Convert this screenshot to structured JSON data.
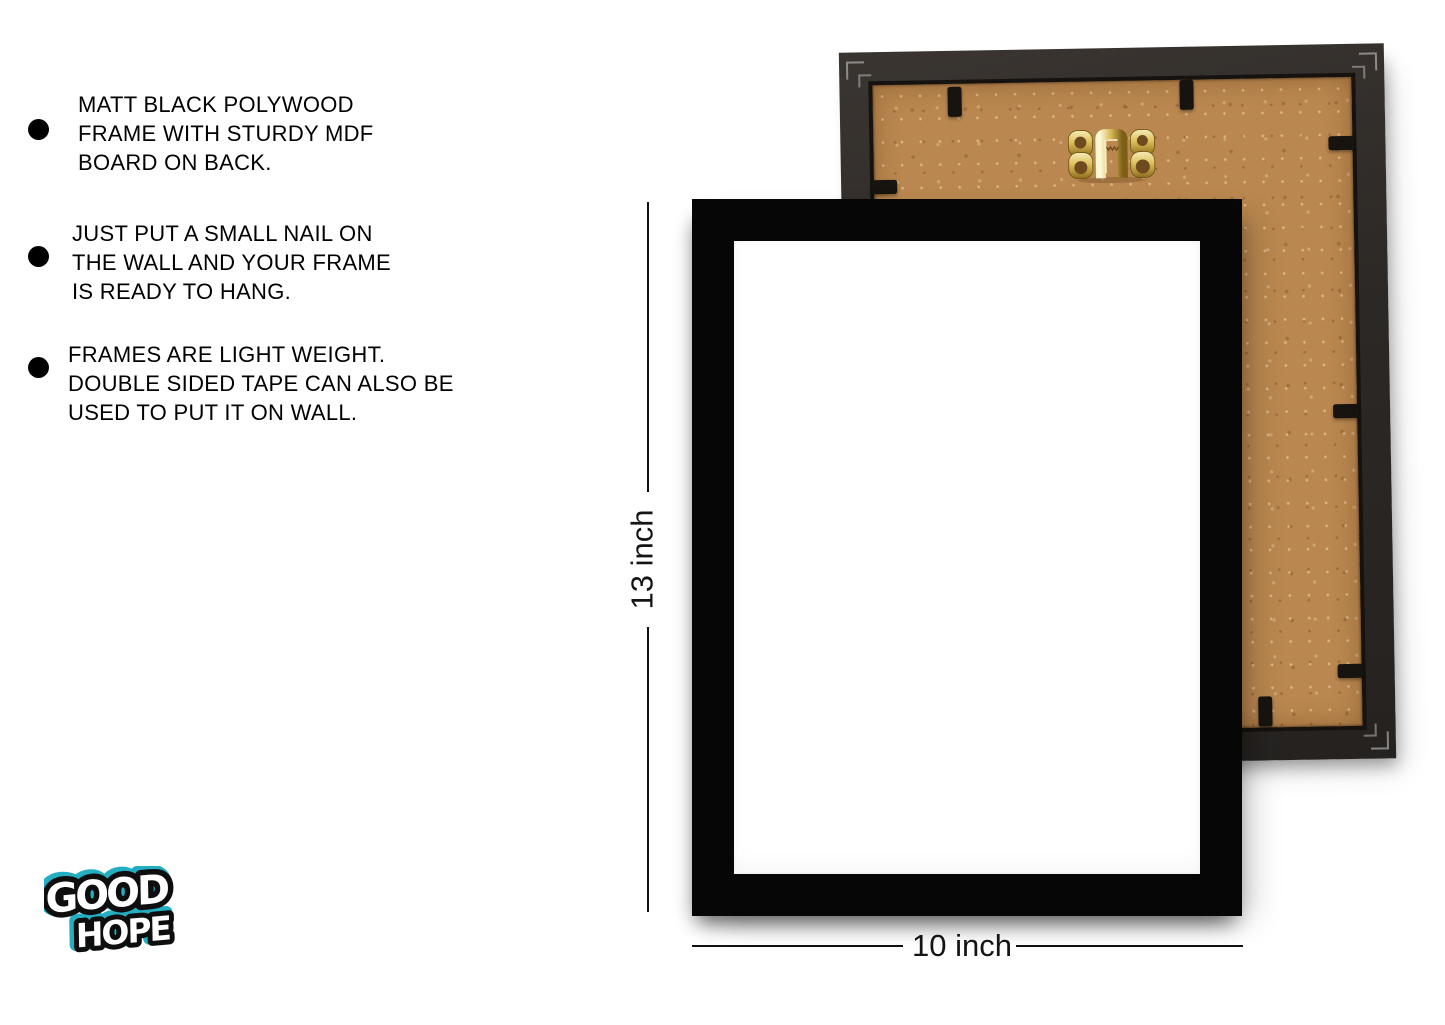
{
  "features": [
    {
      "lines": [
        "MATT BLACK POLYWOOD",
        "FRAME WITH STURDY MDF",
        "BOARD ON BACK."
      ]
    },
    {
      "lines": [
        "JUST PUT A SMALL NAIL ON",
        "THE WALL AND YOUR FRAME",
        "IS READY TO HANG."
      ]
    },
    {
      "lines": [
        "FRAMES ARE LIGHT WEIGHT.",
        "DOUBLE SIDED TAPE CAN ALSO BE",
        "USED TO PUT IT ON WALL."
      ]
    }
  ],
  "dimensions": {
    "height_label": "13 inch",
    "width_label": "10 inch"
  },
  "logo": {
    "word1": "GOOD",
    "word2": "HOPE",
    "accent_color": "#23aec2"
  },
  "colors": {
    "background": "#ffffff",
    "front_frame": "#060606",
    "back_frame_border": "#2c2825",
    "mdf_board": "#b9874f",
    "hanger_gold": "#d9b547",
    "dimension_line": "#111111",
    "text": "#000000"
  }
}
